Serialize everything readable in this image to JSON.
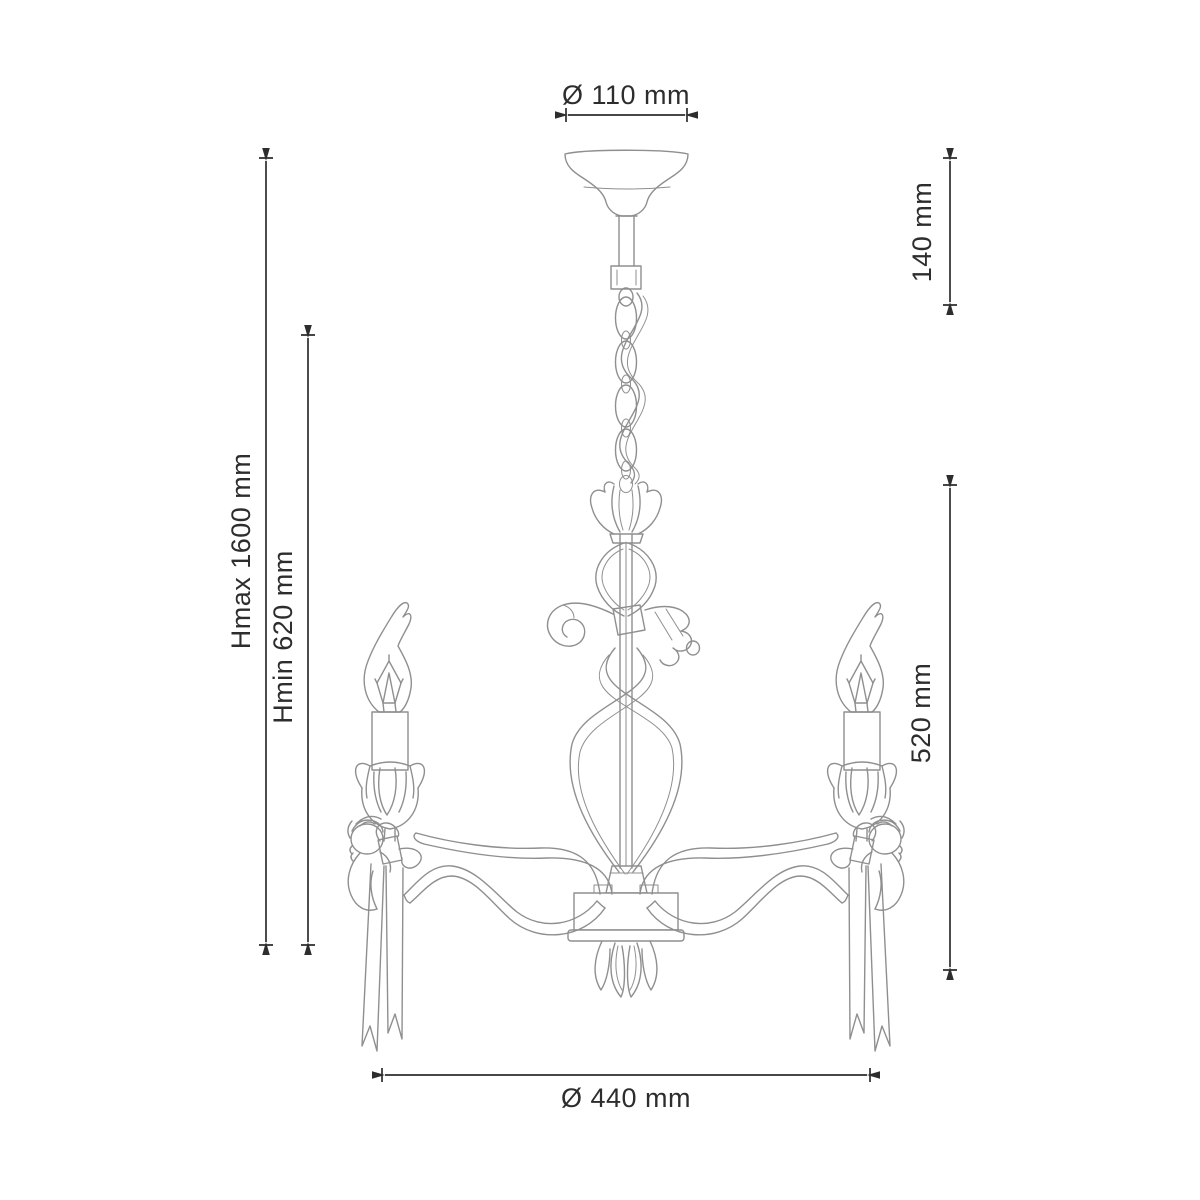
{
  "drawing": {
    "subject": "chandelier-technical-dimension-drawing",
    "labels": {
      "canopy_diameter": "Ø 110 mm",
      "suspension_drop": "140 mm",
      "max_height": "Hmax 1600 mm",
      "min_height": "Hmin 620 mm",
      "fixture_height": "520 mm",
      "fixture_diameter": "Ø 440 mm"
    },
    "colors": {
      "background": "#ffffff",
      "outline": "#8f8f8f",
      "dimension": "#2d2d2d"
    }
  }
}
